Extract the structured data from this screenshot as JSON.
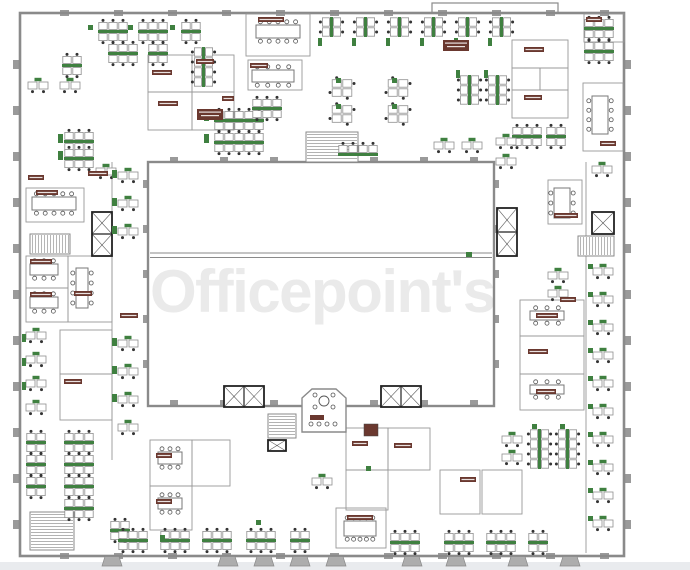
{
  "meta": {
    "watermark": "Officepoint's"
  },
  "colors": {
    "wall": "#8a8a8a",
    "roomLine": "#989898",
    "column": "#9a9a9a",
    "desk": "#8f8f8f",
    "dot": "#333333",
    "green": "#3f8040",
    "label": "#6a382f",
    "black": "#222222",
    "chair": "#555555",
    "watermark": "#eaeaea",
    "footer": "#e9ebee",
    "paper": "#ffffff"
  },
  "canvas": {
    "w": 690,
    "h": 570
  },
  "watermark_layout": {
    "x": 150,
    "y": 312,
    "size": 60,
    "spacing": -1.5
  },
  "plan": {
    "strip": [
      0,
      562,
      690,
      8
    ],
    "walls": [
      [
        20,
        13,
        604,
        543,
        2.6
      ],
      [
        148,
        162,
        346,
        244,
        2.4
      ],
      [
        432,
        3,
        126,
        10,
        1.2
      ]
    ],
    "lines": [
      [
        150,
        253,
        492,
        253,
        1
      ],
      [
        150,
        257.5,
        492,
        257.5,
        1
      ],
      [
        586,
        162,
        586,
        553,
        0.8
      ],
      [
        112,
        162,
        112,
        460,
        0.8
      ]
    ],
    "rooms": [
      [
        148,
        55,
        44,
        37
      ],
      [
        192,
        55,
        42,
        37
      ],
      [
        148,
        92,
        44,
        38
      ],
      [
        192,
        92,
        42,
        38
      ],
      [
        246,
        14,
        64,
        42
      ],
      [
        512,
        40,
        56,
        28
      ],
      [
        512,
        68,
        28,
        22
      ],
      [
        540,
        68,
        28,
        22
      ],
      [
        512,
        90,
        56,
        28
      ],
      [
        583,
        83,
        40,
        68
      ],
      [
        584,
        14,
        40,
        28
      ],
      [
        26,
        188,
        58,
        34
      ],
      [
        26,
        256,
        42,
        32
      ],
      [
        26,
        288,
        42,
        34
      ],
      [
        68,
        256,
        44,
        66
      ],
      [
        60,
        330,
        52,
        44
      ],
      [
        60,
        374,
        52,
        46
      ],
      [
        520,
        300,
        64,
        36
      ],
      [
        520,
        336,
        64,
        38
      ],
      [
        520,
        374,
        64,
        36
      ],
      [
        548,
        180,
        34,
        44
      ],
      [
        150,
        440,
        42,
        46
      ],
      [
        150,
        486,
        42,
        44
      ],
      [
        192,
        440,
        38,
        46
      ],
      [
        346,
        428,
        42,
        42
      ],
      [
        388,
        428,
        42,
        42
      ],
      [
        346,
        470,
        42,
        40
      ],
      [
        336,
        508,
        50,
        40
      ],
      [
        440,
        470,
        40,
        44
      ],
      [
        482,
        470,
        40,
        44
      ],
      [
        248,
        60,
        54,
        30
      ]
    ],
    "benchH": [
      [
        98,
        30,
        3
      ],
      [
        138,
        30,
        3
      ],
      [
        181,
        30,
        2
      ],
      [
        108,
        52,
        3
      ],
      [
        148,
        52,
        2
      ],
      [
        62,
        64,
        2
      ],
      [
        584,
        27,
        3
      ],
      [
        584,
        50,
        3
      ],
      [
        64,
        140,
        3
      ],
      [
        64,
        157,
        3
      ],
      [
        214,
        119,
        5
      ],
      [
        214,
        141,
        5
      ],
      [
        252,
        107,
        3
      ],
      [
        338,
        153,
        4,
        1
      ],
      [
        512,
        135,
        3
      ],
      [
        546,
        135,
        2
      ],
      [
        26,
        441,
        2
      ],
      [
        64,
        441,
        3
      ],
      [
        26,
        463,
        2
      ],
      [
        64,
        463,
        3
      ],
      [
        26,
        485,
        2
      ],
      [
        64,
        485,
        3
      ],
      [
        64,
        507,
        3
      ],
      [
        110,
        529,
        2
      ],
      [
        118,
        539,
        3
      ],
      [
        160,
        539,
        3
      ],
      [
        202,
        539,
        3
      ],
      [
        246,
        539,
        3
      ],
      [
        290,
        539,
        2
      ],
      [
        390,
        541,
        3
      ],
      [
        444,
        541,
        3
      ],
      [
        486,
        541,
        3
      ],
      [
        528,
        541,
        2
      ]
    ],
    "benchV": [
      [
        330,
        17,
        2
      ],
      [
        364,
        17,
        2
      ],
      [
        398,
        17,
        2
      ],
      [
        432,
        17,
        2
      ],
      [
        466,
        17,
        2
      ],
      [
        500,
        17,
        2
      ],
      [
        468,
        75,
        3
      ],
      [
        496,
        75,
        3
      ],
      [
        202,
        47,
        4
      ],
      [
        538,
        429,
        4
      ],
      [
        566,
        429,
        4
      ]
    ],
    "pairDesks": [
      [
        28,
        82
      ],
      [
        60,
        82
      ],
      [
        96,
        168
      ],
      [
        118,
        172
      ],
      [
        118,
        200
      ],
      [
        118,
        228
      ],
      [
        118,
        340
      ],
      [
        118,
        368
      ],
      [
        118,
        396
      ],
      [
        118,
        424
      ],
      [
        26,
        332
      ],
      [
        26,
        356
      ],
      [
        26,
        380
      ],
      [
        26,
        404
      ],
      [
        593,
        268
      ],
      [
        593,
        296
      ],
      [
        593,
        324
      ],
      [
        593,
        352
      ],
      [
        593,
        380
      ],
      [
        593,
        408
      ],
      [
        593,
        436
      ],
      [
        593,
        464
      ],
      [
        593,
        492
      ],
      [
        593,
        520
      ],
      [
        434,
        142
      ],
      [
        462,
        142
      ],
      [
        496,
        138
      ],
      [
        496,
        158
      ],
      [
        592,
        166
      ],
      [
        548,
        272
      ],
      [
        548,
        290
      ],
      [
        502,
        436
      ],
      [
        502,
        454
      ],
      [
        312,
        478
      ]
    ],
    "pinwheels": [
      [
        342,
        88
      ],
      [
        342,
        114
      ],
      [
        398,
        88
      ],
      [
        398,
        114
      ]
    ],
    "meetingTables": [
      [
        256,
        25,
        44,
        13,
        10
      ],
      [
        32,
        197,
        44,
        13,
        10
      ],
      [
        592,
        96,
        16,
        38,
        8
      ],
      [
        554,
        188,
        16,
        30,
        6
      ],
      [
        344,
        521,
        32,
        15,
        10
      ],
      [
        158,
        452,
        24,
        12,
        6
      ],
      [
        30,
        264,
        28,
        11,
        6
      ],
      [
        30,
        297,
        28,
        11,
        6
      ],
      [
        76,
        268,
        12,
        40,
        8
      ],
      [
        252,
        70,
        42,
        12,
        8
      ],
      [
        530,
        311,
        34,
        9,
        6
      ],
      [
        530,
        385,
        34,
        9,
        6
      ],
      [
        158,
        498,
        24,
        11,
        6
      ]
    ],
    "greens": [
      [
        88,
        25,
        5,
        5
      ],
      [
        128,
        25,
        5,
        5
      ],
      [
        170,
        25,
        5,
        5
      ],
      [
        318,
        38,
        4,
        8
      ],
      [
        352,
        38,
        4,
        8
      ],
      [
        386,
        38,
        4,
        8
      ],
      [
        420,
        38,
        4,
        8
      ],
      [
        454,
        38,
        4,
        8
      ],
      [
        488,
        38,
        4,
        8
      ],
      [
        58,
        134,
        5,
        9
      ],
      [
        58,
        151,
        5,
        9
      ],
      [
        204,
        112,
        5,
        9
      ],
      [
        204,
        134,
        5,
        9
      ],
      [
        336,
        78,
        5,
        5
      ],
      [
        336,
        104,
        5,
        5
      ],
      [
        392,
        78,
        5,
        5
      ],
      [
        392,
        104,
        5,
        5
      ],
      [
        456,
        70,
        4,
        8
      ],
      [
        484,
        70,
        4,
        8
      ],
      [
        112,
        170,
        5,
        8
      ],
      [
        112,
        198,
        5,
        8
      ],
      [
        112,
        226,
        5,
        8
      ],
      [
        112,
        338,
        5,
        8
      ],
      [
        112,
        366,
        5,
        8
      ],
      [
        112,
        394,
        5,
        8
      ],
      [
        22,
        334,
        4,
        8
      ],
      [
        22,
        358,
        4,
        8
      ],
      [
        22,
        382,
        4,
        8
      ],
      [
        588,
        264,
        5,
        5
      ],
      [
        588,
        292,
        5,
        5
      ],
      [
        588,
        320,
        5,
        5
      ],
      [
        588,
        348,
        5,
        5
      ],
      [
        588,
        376,
        5,
        5
      ],
      [
        588,
        404,
        5,
        5
      ],
      [
        588,
        432,
        5,
        5
      ],
      [
        588,
        460,
        5,
        5
      ],
      [
        588,
        488,
        5,
        5
      ],
      [
        588,
        516,
        5,
        5
      ],
      [
        532,
        424,
        5,
        5
      ],
      [
        560,
        424,
        5,
        5
      ],
      [
        256,
        520,
        5,
        5
      ],
      [
        160,
        535,
        5,
        5
      ],
      [
        366,
        466,
        5,
        5
      ],
      [
        466,
        252,
        6,
        5
      ]
    ],
    "labels": [
      [
        197,
        109,
        26,
        11
      ],
      [
        443,
        40,
        26,
        11
      ],
      [
        258,
        17,
        26,
        5
      ],
      [
        152,
        70,
        20,
        5
      ],
      [
        196,
        59,
        18,
        5
      ],
      [
        158,
        101,
        20,
        5
      ],
      [
        222,
        96,
        12,
        5
      ],
      [
        524,
        47,
        20,
        5
      ],
      [
        524,
        95,
        18,
        5
      ],
      [
        600,
        141,
        16,
        5
      ],
      [
        36,
        190,
        22,
        5
      ],
      [
        88,
        171,
        20,
        5
      ],
      [
        28,
        175,
        16,
        5
      ],
      [
        30,
        259,
        22,
        5
      ],
      [
        30,
        292,
        22,
        5
      ],
      [
        74,
        291,
        18,
        5
      ],
      [
        64,
        379,
        18,
        5
      ],
      [
        536,
        313,
        22,
        5
      ],
      [
        528,
        349,
        20,
        5
      ],
      [
        536,
        389,
        20,
        5
      ],
      [
        554,
        213,
        24,
        5
      ],
      [
        560,
        297,
        16,
        5
      ],
      [
        156,
        453,
        16,
        5
      ],
      [
        156,
        499,
        16,
        5
      ],
      [
        352,
        441,
        16,
        5
      ],
      [
        394,
        443,
        18,
        5
      ],
      [
        347,
        515,
        26,
        5
      ],
      [
        460,
        477,
        16,
        5
      ],
      [
        120,
        313,
        18,
        5
      ],
      [
        250,
        63,
        18,
        5
      ],
      [
        586,
        17,
        16,
        5
      ]
    ],
    "blocks": [
      [
        364,
        424,
        14,
        12
      ]
    ],
    "stairs": [
      [
        306,
        132,
        52,
        30,
        "v"
      ],
      [
        30,
        234,
        40,
        20,
        "h"
      ],
      [
        578,
        236,
        36,
        20,
        "h"
      ],
      [
        268,
        414,
        28,
        24,
        "v"
      ],
      [
        30,
        512,
        44,
        38,
        "v"
      ]
    ],
    "elevators": [
      [
        92,
        212,
        20,
        44,
        2
      ],
      [
        497,
        208,
        20,
        48,
        2
      ],
      [
        224,
        386,
        40,
        21,
        2
      ],
      [
        381,
        386,
        40,
        21,
        2
      ],
      [
        592,
        212,
        22,
        22,
        1
      ],
      [
        268,
        440,
        18,
        11,
        1
      ]
    ],
    "octagon": {
      "points": "302,398 312,389 336,389 346,398 346,432 302,432",
      "table": [
        324,
        401,
        5
      ],
      "chairs": [
        [
          315,
          395
        ],
        [
          333,
          395
        ],
        [
          315,
          407
        ],
        [
          333,
          407
        ],
        [
          311,
          424
        ],
        [
          319,
          424
        ],
        [
          327,
          424
        ],
        [
          335,
          424
        ]
      ],
      "label": [
        310,
        415,
        14,
        5
      ]
    },
    "columns": [
      [
        13,
        60,
        7,
        9
      ],
      [
        13,
        106,
        7,
        9
      ],
      [
        13,
        152,
        7,
        9
      ],
      [
        13,
        198,
        7,
        9
      ],
      [
        13,
        244,
        7,
        9
      ],
      [
        13,
        290,
        7,
        9
      ],
      [
        13,
        336,
        7,
        9
      ],
      [
        13,
        382,
        7,
        9
      ],
      [
        13,
        428,
        7,
        9
      ],
      [
        13,
        474,
        7,
        9
      ],
      [
        13,
        520,
        7,
        9
      ],
      [
        624,
        60,
        7,
        9
      ],
      [
        624,
        106,
        7,
        9
      ],
      [
        624,
        152,
        7,
        9
      ],
      [
        624,
        198,
        7,
        9
      ],
      [
        624,
        244,
        7,
        9
      ],
      [
        624,
        290,
        7,
        9
      ],
      [
        624,
        336,
        7,
        9
      ],
      [
        624,
        382,
        7,
        9
      ],
      [
        624,
        428,
        7,
        9
      ],
      [
        624,
        474,
        7,
        9
      ],
      [
        624,
        520,
        7,
        9
      ],
      [
        60,
        10,
        9,
        6
      ],
      [
        114,
        10,
        9,
        6
      ],
      [
        168,
        10,
        9,
        6
      ],
      [
        222,
        10,
        9,
        6
      ],
      [
        276,
        10,
        9,
        6
      ],
      [
        330,
        10,
        9,
        6
      ],
      [
        384,
        10,
        9,
        6
      ],
      [
        438,
        10,
        9,
        6
      ],
      [
        492,
        10,
        9,
        6
      ],
      [
        546,
        10,
        9,
        6
      ],
      [
        600,
        10,
        9,
        6
      ],
      [
        60,
        553,
        9,
        6
      ],
      [
        114,
        553,
        9,
        6
      ],
      [
        168,
        553,
        9,
        6
      ],
      [
        222,
        553,
        9,
        6
      ],
      [
        276,
        553,
        9,
        6
      ],
      [
        330,
        553,
        9,
        6
      ],
      [
        384,
        553,
        9,
        6
      ],
      [
        438,
        553,
        9,
        6
      ],
      [
        492,
        553,
        9,
        6
      ],
      [
        546,
        553,
        9,
        6
      ],
      [
        600,
        553,
        9,
        6
      ],
      [
        170,
        157,
        8,
        6
      ],
      [
        220,
        157,
        8,
        6
      ],
      [
        270,
        157,
        8,
        6
      ],
      [
        320,
        157,
        8,
        6
      ],
      [
        370,
        157,
        8,
        6
      ],
      [
        420,
        157,
        8,
        6
      ],
      [
        470,
        157,
        8,
        6
      ],
      [
        143,
        180,
        6,
        8
      ],
      [
        143,
        225,
        6,
        8
      ],
      [
        143,
        270,
        6,
        8
      ],
      [
        143,
        315,
        6,
        8
      ],
      [
        143,
        360,
        6,
        8
      ],
      [
        493,
        180,
        6,
        8
      ],
      [
        493,
        225,
        6,
        8
      ],
      [
        493,
        270,
        6,
        8
      ],
      [
        493,
        315,
        6,
        8
      ],
      [
        493,
        360,
        6,
        8
      ],
      [
        170,
        400,
        8,
        6
      ],
      [
        220,
        400,
        8,
        6
      ],
      [
        270,
        400,
        8,
        6
      ],
      [
        370,
        400,
        8,
        6
      ],
      [
        420,
        400,
        8,
        6
      ],
      [
        470,
        400,
        8,
        6
      ]
    ],
    "footings": [
      112,
      228,
      264,
      300,
      336,
      412,
      456,
      518,
      570
    ]
  }
}
